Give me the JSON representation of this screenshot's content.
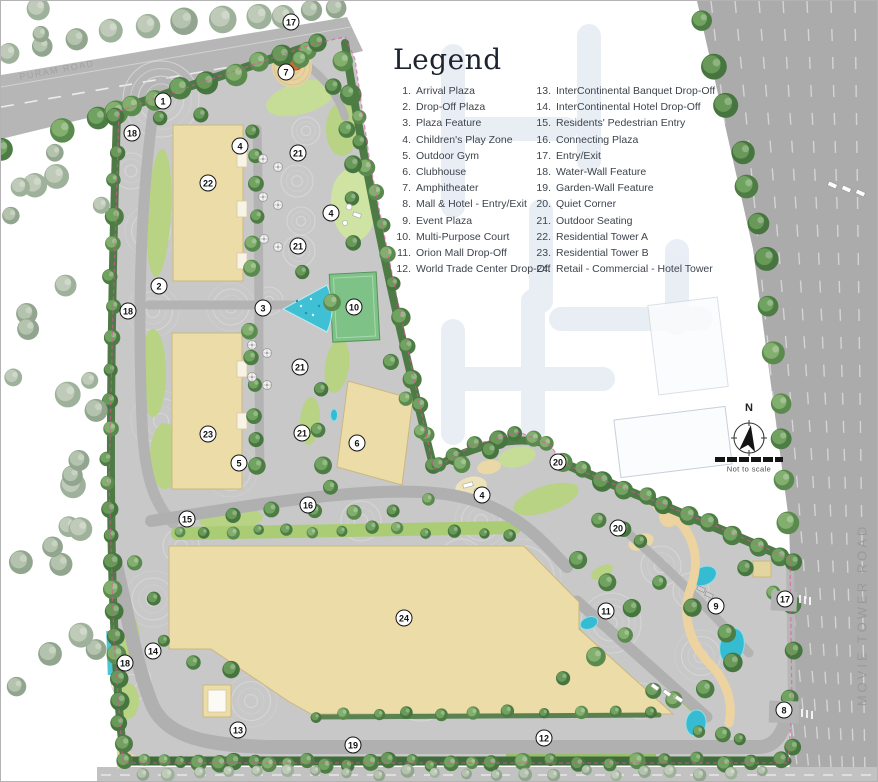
{
  "legend": {
    "title": "Legend",
    "items": [
      {
        "n": "1",
        "label": "Arrival Plaza"
      },
      {
        "n": "2",
        "label": "Drop-Off Plaza"
      },
      {
        "n": "3",
        "label": "Plaza Feature"
      },
      {
        "n": "4",
        "label": "Children's Play Zone"
      },
      {
        "n": "5",
        "label": "Outdoor Gym"
      },
      {
        "n": "6",
        "label": "Clubhouse"
      },
      {
        "n": "7",
        "label": "Amphitheater"
      },
      {
        "n": "8",
        "label": "Mall & Hotel - Entry/Exit"
      },
      {
        "n": "9",
        "label": "Event Plaza"
      },
      {
        "n": "10",
        "label": "Multi-Purpose Court"
      },
      {
        "n": "11",
        "label": "Orion Mall Drop-Off"
      },
      {
        "n": "12",
        "label": "World Trade Center Drop-Off"
      },
      {
        "n": "13",
        "label": "InterContinental Banquet Drop-Off"
      },
      {
        "n": "14",
        "label": "InterContinental Hotel Drop-Off"
      },
      {
        "n": "15",
        "label": "Residents' Pedestrian Entry"
      },
      {
        "n": "16",
        "label": "Connecting Plaza"
      },
      {
        "n": "17",
        "label": "Entry/Exit"
      },
      {
        "n": "18",
        "label": "Water-Wall Feature"
      },
      {
        "n": "19",
        "label": "Garden-Wall Feature"
      },
      {
        "n": "20",
        "label": "Quiet Corner"
      },
      {
        "n": "21",
        "label": "Outdoor Seating"
      },
      {
        "n": "22",
        "label": "Residential Tower A"
      },
      {
        "n": "23",
        "label": "Residential Tower B"
      },
      {
        "n": "24",
        "label": "Retail - Commercial - Hotel Tower"
      }
    ]
  },
  "map": {
    "road_labels": {
      "right": "MOVIE TOWER ROAD",
      "top_left": "PURAM ROAD"
    },
    "north": {
      "n": "N",
      "note": "Not to scale"
    },
    "markers": [
      {
        "n": "17",
        "x": 290,
        "y": 21
      },
      {
        "n": "7",
        "x": 285,
        "y": 71
      },
      {
        "n": "1",
        "x": 162,
        "y": 100
      },
      {
        "n": "18",
        "x": 131,
        "y": 132
      },
      {
        "n": "4",
        "x": 239,
        "y": 145
      },
      {
        "n": "21",
        "x": 297,
        "y": 152
      },
      {
        "n": "22",
        "x": 207,
        "y": 182
      },
      {
        "n": "4",
        "x": 330,
        "y": 212
      },
      {
        "n": "21",
        "x": 297,
        "y": 245
      },
      {
        "n": "2",
        "x": 158,
        "y": 285
      },
      {
        "n": "3",
        "x": 262,
        "y": 307
      },
      {
        "n": "10",
        "x": 353,
        "y": 306
      },
      {
        "n": "18",
        "x": 127,
        "y": 310
      },
      {
        "n": "21",
        "x": 299,
        "y": 366
      },
      {
        "n": "21",
        "x": 301,
        "y": 432
      },
      {
        "n": "23",
        "x": 207,
        "y": 433
      },
      {
        "n": "6",
        "x": 356,
        "y": 442
      },
      {
        "n": "5",
        "x": 238,
        "y": 462
      },
      {
        "n": "20",
        "x": 557,
        "y": 461
      },
      {
        "n": "4",
        "x": 481,
        "y": 494
      },
      {
        "n": "16",
        "x": 307,
        "y": 504
      },
      {
        "n": "15",
        "x": 186,
        "y": 518
      },
      {
        "n": "20",
        "x": 617,
        "y": 527
      },
      {
        "n": "17",
        "x": 784,
        "y": 598
      },
      {
        "n": "9",
        "x": 715,
        "y": 605
      },
      {
        "n": "11",
        "x": 605,
        "y": 610
      },
      {
        "n": "24",
        "x": 403,
        "y": 617
      },
      {
        "n": "14",
        "x": 152,
        "y": 650
      },
      {
        "n": "18",
        "x": 124,
        "y": 662
      },
      {
        "n": "8",
        "x": 783,
        "y": 709
      },
      {
        "n": "13",
        "x": 237,
        "y": 729
      },
      {
        "n": "12",
        "x": 543,
        "y": 737
      },
      {
        "n": "19",
        "x": 352,
        "y": 744
      }
    ]
  },
  "colors": {
    "building_tan": "#ecdca7",
    "water_cyan": "#3fc0d4",
    "lawn_green": "#b8d383",
    "court_green": "#7fc287",
    "road_gray": "#ababab",
    "boundary_magenta": "#e550a5",
    "tree_green": "#4e7c45"
  }
}
